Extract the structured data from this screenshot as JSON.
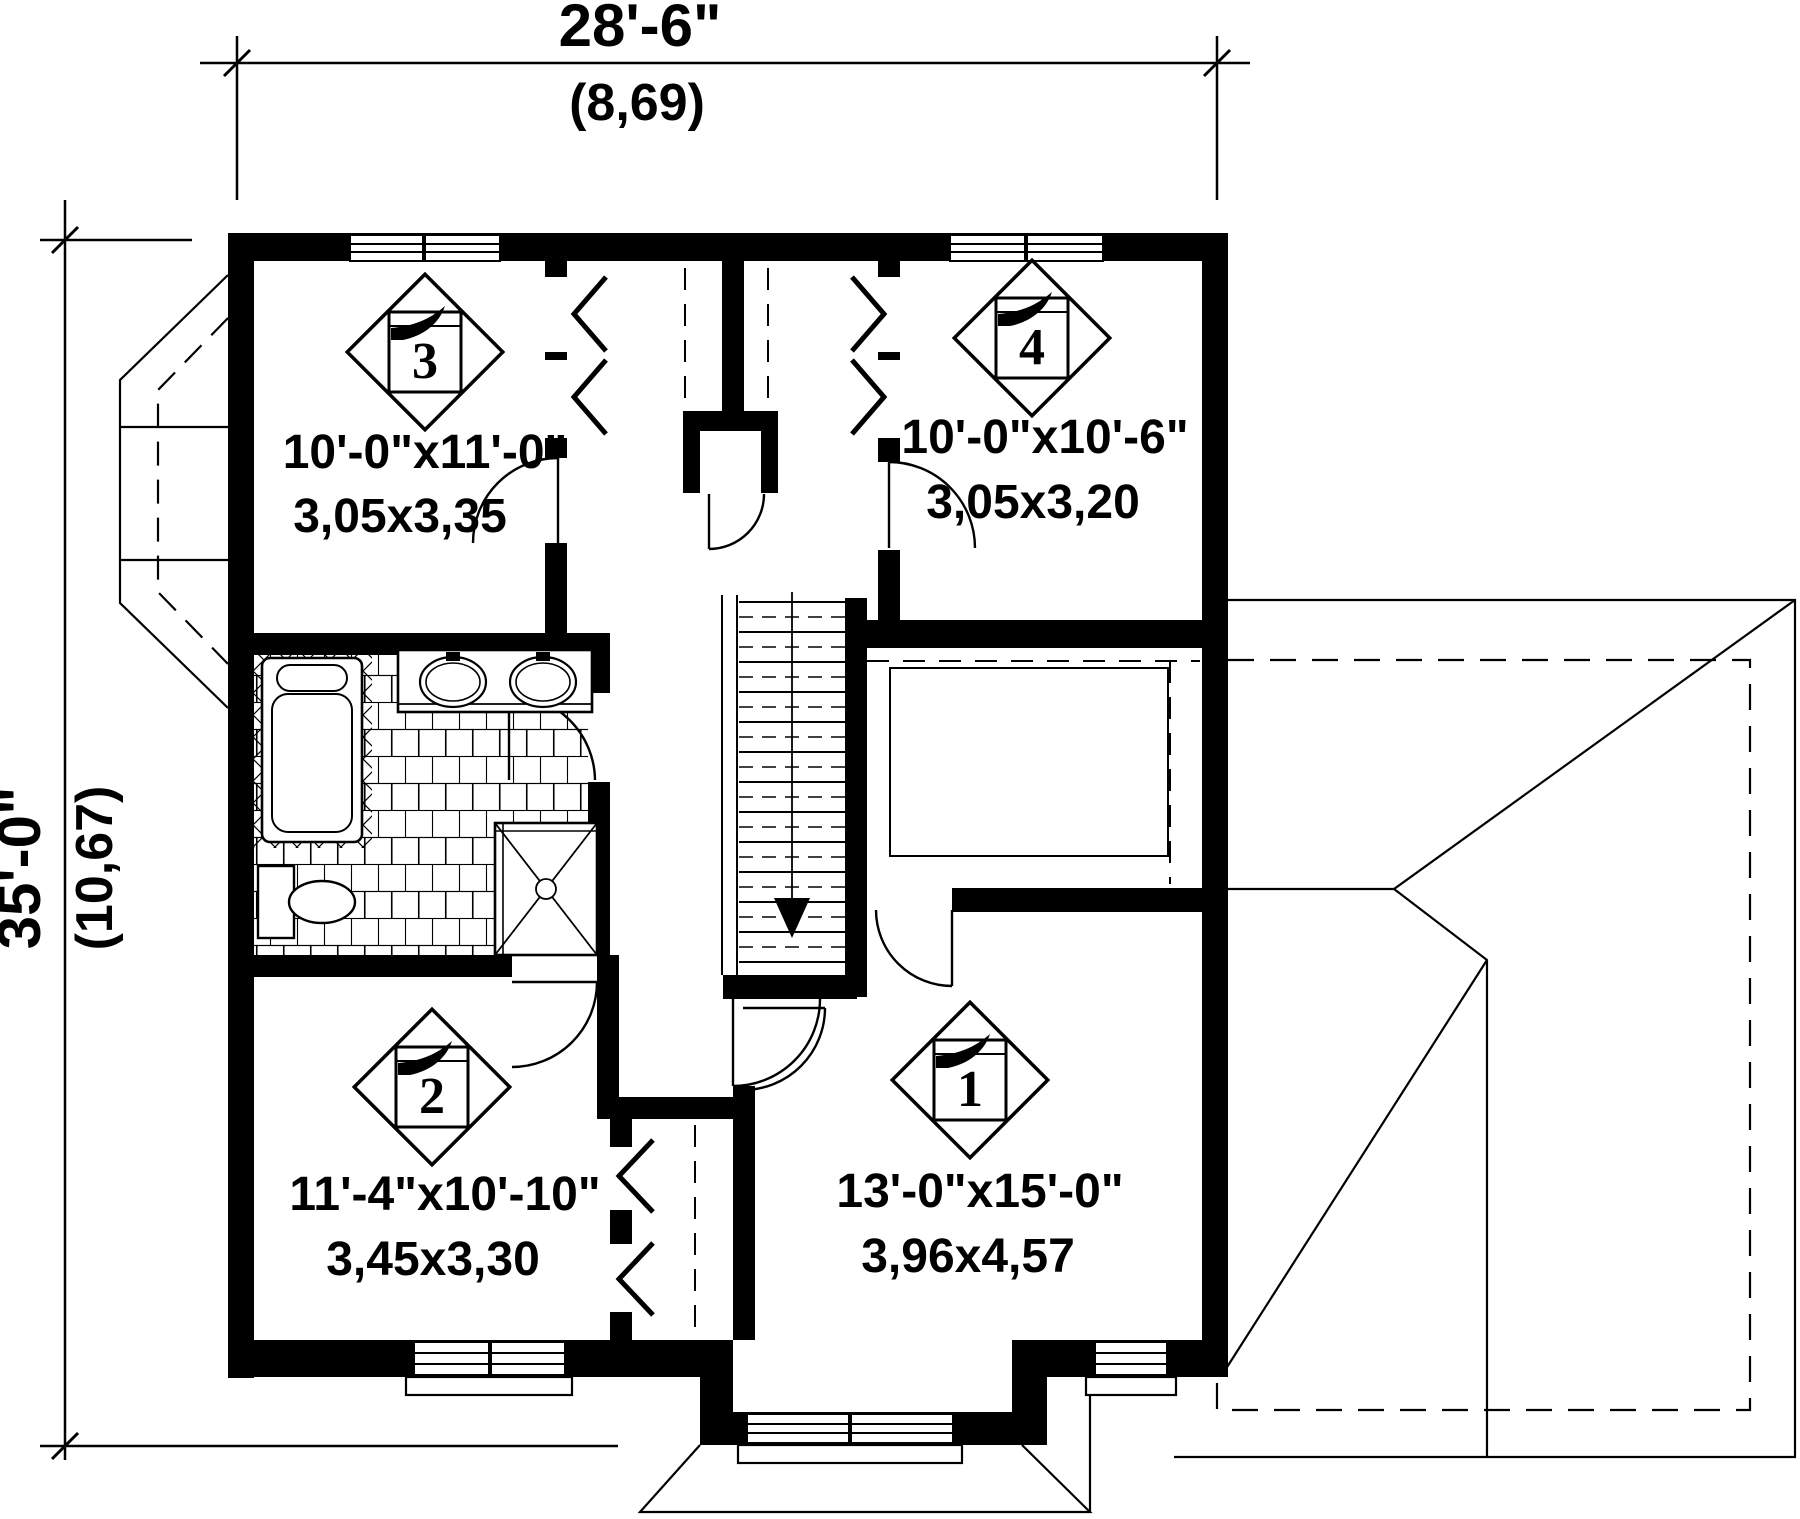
{
  "plan": {
    "type": "second-floor-plan",
    "colors": {
      "ink": "#000000",
      "paper": "#ffffff"
    },
    "dimensions": {
      "width": {
        "imperial": "28'-6\"",
        "metric": "(8,69)"
      },
      "height": {
        "imperial": "35'-0\"",
        "metric": "(10,67)"
      }
    },
    "rooms": [
      {
        "number": "1",
        "size_imperial": "13'-0\"x15'-0\"",
        "size_metric": "3,96x4,57"
      },
      {
        "number": "2",
        "size_imperial": "11'-4\"x10'-10\"",
        "size_metric": "3,45x3,30"
      },
      {
        "number": "3",
        "size_imperial": "10'-0\"x11'-0\"",
        "size_metric": "3,05x3,35"
      },
      {
        "number": "4",
        "size_imperial": "10'-0\"x10'-6\"",
        "size_metric": "3,05x3,20"
      }
    ],
    "symbols": {
      "stair_direction": "down-arrow"
    }
  }
}
